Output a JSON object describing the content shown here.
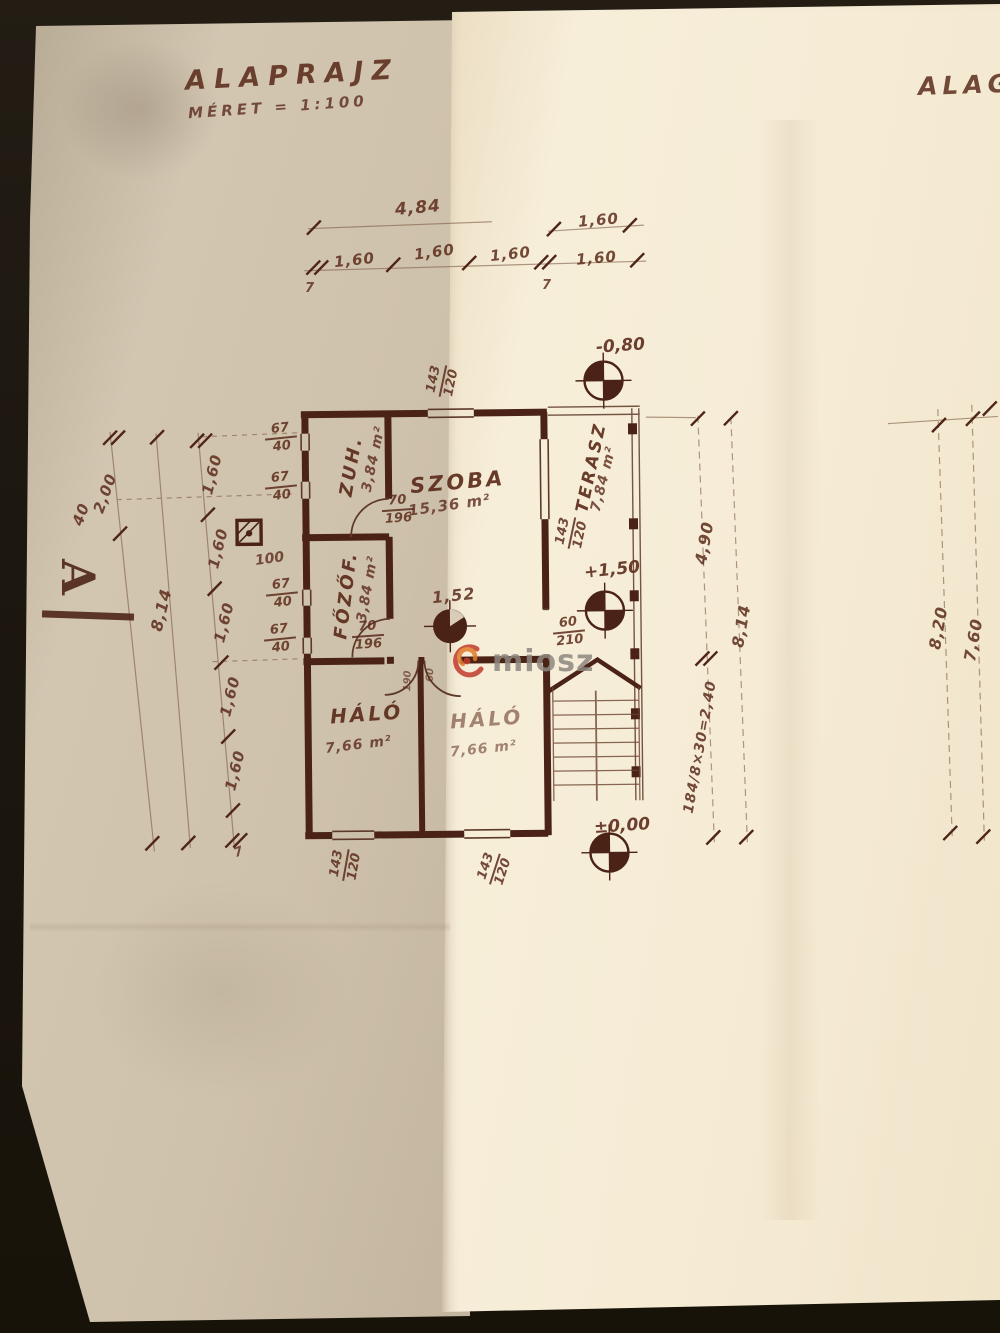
{
  "page": {
    "title": "ALAPRAJZ",
    "scale": "MÉRET = 1:100",
    "corner_text": "ALAGS",
    "watermark": "miosz",
    "ink_color": "#4a2316",
    "paper_color": "#f6ecd6",
    "accent_red": "#c23b2e",
    "accent_orange": "#e07b2a"
  },
  "rooms": [
    {
      "name": "ZUH.",
      "area": "3,84 m²"
    },
    {
      "name": "FŐZŐF.",
      "area": "3,84 m²"
    },
    {
      "name": "SZOBA",
      "area": "15,36 m²"
    },
    {
      "name": "TERASZ",
      "area": "7,84 m²"
    },
    {
      "name": "HÁLÓ",
      "area": "7,66 m²"
    },
    {
      "name": "HÁLÓ",
      "area": "7,66 m²"
    }
  ],
  "levels": {
    "basement": "-0,80",
    "terrace": "+1,50",
    "ground": "±0,00"
  },
  "marker": {
    "section_letter": "A"
  },
  "dims": {
    "total_top": "4,84",
    "seg": "1,60",
    "seven": "7",
    "two": "2,00",
    "forty": "40",
    "total_left": "8,14",
    "win_w": "67",
    "win_h": "40",
    "hundred": "100",
    "door_w": "70",
    "door_h": "196",
    "d152": "1,52",
    "door2_w": "60",
    "door2_h": "210",
    "win2_w": "143",
    "win2_h": "120",
    "right_490": "4,90",
    "stairs": "184/8×30=2,40",
    "total_right": "8,14",
    "right_820": "8,20",
    "right_760": "7,60",
    "tiny_190": "190",
    "tiny_60": "60"
  }
}
